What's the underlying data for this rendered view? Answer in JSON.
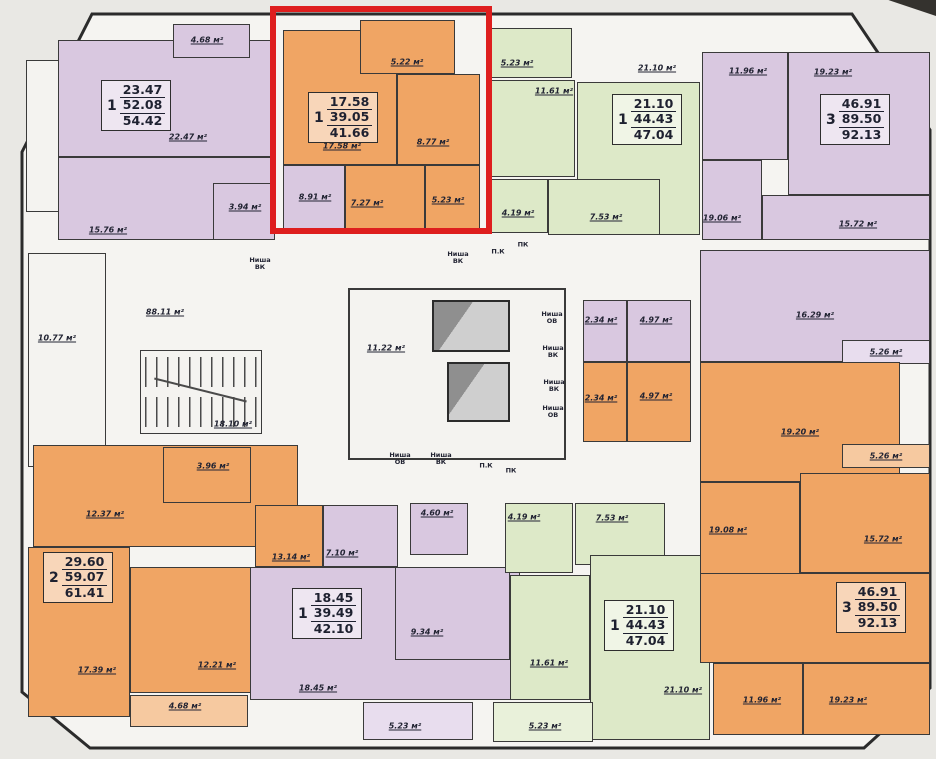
{
  "palette": {
    "apartment_orange": "#f0a564",
    "apartment_purple": "#d9c8e0",
    "apartment_green": "#dde9c8",
    "common_area": "#f4f3f0",
    "wall": "#3a3a3a",
    "highlight_red": "#de1e1e",
    "label_ink": "#222433"
  },
  "highlight": {
    "x": 270,
    "y": 6,
    "w": 222,
    "h": 228,
    "border": 6,
    "color": "#de1e1e"
  },
  "summary_blocks": [
    {
      "rooms": "1",
      "line1": "23.47",
      "line2": "52.08",
      "line3": "54.42",
      "x": 101,
      "y": 80
    },
    {
      "rooms": "1",
      "line1": "17.58",
      "line2": "39.05",
      "line3": "41.66",
      "x": 308,
      "y": 92
    },
    {
      "rooms": "1",
      "line1": "21.10",
      "line2": "44.43",
      "line3": "47.04",
      "x": 612,
      "y": 94
    },
    {
      "rooms": "3",
      "line1": "46.91",
      "line2": "89.50",
      "line3": "92.13",
      "x": 820,
      "y": 94
    },
    {
      "rooms": "2",
      "line1": "29.60",
      "line2": "59.07",
      "line3": "61.41",
      "x": 43,
      "y": 552
    },
    {
      "rooms": "1",
      "line1": "18.45",
      "line2": "39.49",
      "line3": "42.10",
      "x": 292,
      "y": 588
    },
    {
      "rooms": "1",
      "line1": "21.10",
      "line2": "44.43",
      "line3": "47.04",
      "x": 604,
      "y": 600
    },
    {
      "rooms": "3",
      "line1": "46.91",
      "line2": "89.50",
      "line3": "92.13",
      "x": 836,
      "y": 582
    }
  ],
  "room_labels": [
    {
      "t": "4.68 м²",
      "x": 207,
      "y": 40
    },
    {
      "t": "22.47 м²",
      "x": 188,
      "y": 137
    },
    {
      "t": "15.76 м²",
      "x": 108,
      "y": 230
    },
    {
      "t": "3.94 м²",
      "x": 245,
      "y": 207
    },
    {
      "t": "10.77 м²",
      "x": 57,
      "y": 338
    },
    {
      "t": "5.22 м²",
      "x": 407,
      "y": 62
    },
    {
      "t": "17.58 м²",
      "x": 342,
      "y": 146
    },
    {
      "t": "8.77 м²",
      "x": 433,
      "y": 142
    },
    {
      "t": "8.91 м²",
      "x": 315,
      "y": 197
    },
    {
      "t": "7.27 м²",
      "x": 367,
      "y": 203
    },
    {
      "t": "5.23 м²",
      "x": 448,
      "y": 200
    },
    {
      "t": "5.23 м²",
      "x": 517,
      "y": 63
    },
    {
      "t": "11.61 м²",
      "x": 554,
      "y": 91
    },
    {
      "t": "21.10 м²",
      "x": 657,
      "y": 68
    },
    {
      "t": "4.19 м²",
      "x": 518,
      "y": 213
    },
    {
      "t": "7.53 м²",
      "x": 606,
      "y": 217
    },
    {
      "t": "11.96 м²",
      "x": 748,
      "y": 71
    },
    {
      "t": "19.23 м²",
      "x": 833,
      "y": 72
    },
    {
      "t": "19.06 м²",
      "x": 722,
      "y": 218
    },
    {
      "t": "15.72 м²",
      "x": 858,
      "y": 224
    },
    {
      "t": "88.11 м²",
      "x": 165,
      "y": 312
    },
    {
      "t": "18.10 м²",
      "x": 233,
      "y": 424
    },
    {
      "t": "11.22 м²",
      "x": 386,
      "y": 348
    },
    {
      "t": "2.34 м²",
      "x": 601,
      "y": 320
    },
    {
      "t": "4.97 м²",
      "x": 656,
      "y": 320
    },
    {
      "t": "2.34 м²",
      "x": 601,
      "y": 398
    },
    {
      "t": "4.97 м²",
      "x": 656,
      "y": 396
    },
    {
      "t": "16.29 м²",
      "x": 815,
      "y": 315
    },
    {
      "t": "5.26 м²",
      "x": 886,
      "y": 352
    },
    {
      "t": "19.20 м²",
      "x": 800,
      "y": 432
    },
    {
      "t": "5.26 м²",
      "x": 886,
      "y": 456
    },
    {
      "t": "3.96 м²",
      "x": 213,
      "y": 466
    },
    {
      "t": "12.37 м²",
      "x": 105,
      "y": 514
    },
    {
      "t": "13.14 м²",
      "x": 291,
      "y": 557
    },
    {
      "t": "7.10 м²",
      "x": 342,
      "y": 553
    },
    {
      "t": "4.60 м²",
      "x": 437,
      "y": 513
    },
    {
      "t": "4.19 м²",
      "x": 524,
      "y": 517
    },
    {
      "t": "7.53 м²",
      "x": 612,
      "y": 518
    },
    {
      "t": "9.34 м²",
      "x": 427,
      "y": 632
    },
    {
      "t": "17.39 м²",
      "x": 97,
      "y": 670
    },
    {
      "t": "12.21 м²",
      "x": 217,
      "y": 665
    },
    {
      "t": "4.68 м²",
      "x": 185,
      "y": 706
    },
    {
      "t": "18.45 м²",
      "x": 318,
      "y": 688
    },
    {
      "t": "5.23 м²",
      "x": 405,
      "y": 726
    },
    {
      "t": "11.61 м²",
      "x": 549,
      "y": 663
    },
    {
      "t": "5.23 м²",
      "x": 545,
      "y": 726
    },
    {
      "t": "21.10 м²",
      "x": 683,
      "y": 690
    },
    {
      "t": "19.08 м²",
      "x": 728,
      "y": 530
    },
    {
      "t": "15.72 м²",
      "x": 883,
      "y": 539
    },
    {
      "t": "11.96 м²",
      "x": 762,
      "y": 700
    },
    {
      "t": "19.23 м²",
      "x": 848,
      "y": 700
    }
  ],
  "niche_labels": [
    {
      "t": "Ниша\nВК",
      "x": 260,
      "y": 264
    },
    {
      "t": "Ниша\nВК",
      "x": 458,
      "y": 258
    },
    {
      "t": "П.К",
      "x": 498,
      "y": 252
    },
    {
      "t": "ПК",
      "x": 523,
      "y": 245
    },
    {
      "t": "Ниша\nОВ",
      "x": 552,
      "y": 318
    },
    {
      "t": "Ниша\nВК",
      "x": 553,
      "y": 352
    },
    {
      "t": "Ниша\nВК",
      "x": 554,
      "y": 386
    },
    {
      "t": "Ниша\nОВ",
      "x": 553,
      "y": 412
    },
    {
      "t": "Ниша\nОВ",
      "x": 400,
      "y": 459
    },
    {
      "t": "Ниша\nВК",
      "x": 441,
      "y": 459
    },
    {
      "t": "П.К",
      "x": 486,
      "y": 466
    },
    {
      "t": "ПК",
      "x": 511,
      "y": 471
    }
  ],
  "rooms": [
    {
      "c": "white",
      "x": 26,
      "y": 60,
      "w": 34,
      "h": 152
    },
    {
      "c": "purple",
      "x": 58,
      "y": 40,
      "w": 217,
      "h": 117
    },
    {
      "c": "purple",
      "x": 58,
      "y": 157,
      "w": 217,
      "h": 83
    },
    {
      "c": "purple",
      "x": 213,
      "y": 183,
      "w": 62,
      "h": 57
    },
    {
      "c": "purple",
      "x": 173,
      "y": 24,
      "w": 77,
      "h": 34
    },
    {
      "c": "orange",
      "x": 283,
      "y": 30,
      "w": 114,
      "h": 135
    },
    {
      "c": "orange",
      "x": 360,
      "y": 20,
      "w": 95,
      "h": 54
    },
    {
      "c": "orange",
      "x": 397,
      "y": 74,
      "w": 83,
      "h": 91
    },
    {
      "c": "purple",
      "x": 283,
      "y": 165,
      "w": 62,
      "h": 65
    },
    {
      "c": "orange",
      "x": 345,
      "y": 165,
      "w": 80,
      "h": 65
    },
    {
      "c": "orange",
      "x": 425,
      "y": 165,
      "w": 55,
      "h": 65
    },
    {
      "c": "green",
      "x": 490,
      "y": 28,
      "w": 82,
      "h": 50
    },
    {
      "c": "green",
      "x": 487,
      "y": 80,
      "w": 88,
      "h": 97
    },
    {
      "c": "green",
      "x": 577,
      "y": 82,
      "w": 123,
      "h": 153
    },
    {
      "c": "green",
      "x": 487,
      "y": 179,
      "w": 61,
      "h": 54
    },
    {
      "c": "green",
      "x": 548,
      "y": 179,
      "w": 112,
      "h": 56
    },
    {
      "c": "purple",
      "x": 702,
      "y": 52,
      "w": 86,
      "h": 108
    },
    {
      "c": "purple",
      "x": 788,
      "y": 52,
      "w": 142,
      "h": 143
    },
    {
      "c": "purple",
      "x": 702,
      "y": 160,
      "w": 60,
      "h": 80
    },
    {
      "c": "purple",
      "x": 762,
      "y": 195,
      "w": 168,
      "h": 45
    },
    {
      "c": "white",
      "x": 28,
      "y": 253,
      "w": 78,
      "h": 214
    },
    {
      "c": "purple",
      "x": 583,
      "y": 300,
      "w": 44,
      "h": 62
    },
    {
      "c": "purple",
      "x": 627,
      "y": 300,
      "w": 64,
      "h": 62
    },
    {
      "c": "orange",
      "x": 583,
      "y": 362,
      "w": 44,
      "h": 80
    },
    {
      "c": "orange",
      "x": 627,
      "y": 362,
      "w": 64,
      "h": 80
    },
    {
      "c": "purple",
      "x": 700,
      "y": 250,
      "w": 230,
      "h": 112
    },
    {
      "c": "lightpurple",
      "x": 842,
      "y": 340,
      "w": 88,
      "h": 24
    },
    {
      "c": "orange",
      "x": 700,
      "y": 362,
      "w": 200,
      "h": 120
    },
    {
      "c": "lightorange",
      "x": 842,
      "y": 444,
      "w": 88,
      "h": 24
    },
    {
      "c": "orange",
      "x": 33,
      "y": 445,
      "w": 265,
      "h": 102
    },
    {
      "c": "orange",
      "x": 163,
      "y": 447,
      "w": 88,
      "h": 56
    },
    {
      "c": "orange",
      "x": 255,
      "y": 505,
      "w": 68,
      "h": 62
    },
    {
      "c": "orange",
      "x": 28,
      "y": 547,
      "w": 102,
      "h": 170
    },
    {
      "c": "orange",
      "x": 130,
      "y": 567,
      "w": 122,
      "h": 126
    },
    {
      "c": "lightorange",
      "x": 130,
      "y": 695,
      "w": 118,
      "h": 32
    },
    {
      "c": "purple",
      "x": 323,
      "y": 505,
      "w": 75,
      "h": 62
    },
    {
      "c": "purple",
      "x": 410,
      "y": 503,
      "w": 58,
      "h": 52
    },
    {
      "c": "purple",
      "x": 250,
      "y": 567,
      "w": 270,
      "h": 133
    },
    {
      "c": "purple",
      "x": 395,
      "y": 567,
      "w": 115,
      "h": 93
    },
    {
      "c": "lightpurple",
      "x": 363,
      "y": 702,
      "w": 110,
      "h": 38
    },
    {
      "c": "green",
      "x": 505,
      "y": 503,
      "w": 68,
      "h": 70
    },
    {
      "c": "green",
      "x": 575,
      "y": 503,
      "w": 90,
      "h": 62
    },
    {
      "c": "green",
      "x": 510,
      "y": 575,
      "w": 80,
      "h": 125
    },
    {
      "c": "green",
      "x": 590,
      "y": 555,
      "w": 120,
      "h": 185
    },
    {
      "c": "lightgreen",
      "x": 493,
      "y": 702,
      "w": 100,
      "h": 40
    },
    {
      "c": "orange",
      "x": 700,
      "y": 482,
      "w": 100,
      "h": 108
    },
    {
      "c": "orange",
      "x": 800,
      "y": 473,
      "w": 130,
      "h": 100
    },
    {
      "c": "orange",
      "x": 700,
      "y": 573,
      "w": 230,
      "h": 90
    },
    {
      "c": "orange",
      "x": 713,
      "y": 663,
      "w": 90,
      "h": 72
    },
    {
      "c": "orange",
      "x": 803,
      "y": 663,
      "w": 127,
      "h": 72
    }
  ],
  "fixtures": {
    "stairs": {
      "x": 140,
      "y": 350,
      "w": 122,
      "h": 84
    },
    "elevator_hall": {
      "x": 348,
      "y": 288,
      "w": 218,
      "h": 172
    },
    "shafts": [
      {
        "x": 432,
        "y": 300,
        "w": 78,
        "h": 52
      },
      {
        "x": 447,
        "y": 362,
        "w": 63,
        "h": 60
      }
    ]
  }
}
